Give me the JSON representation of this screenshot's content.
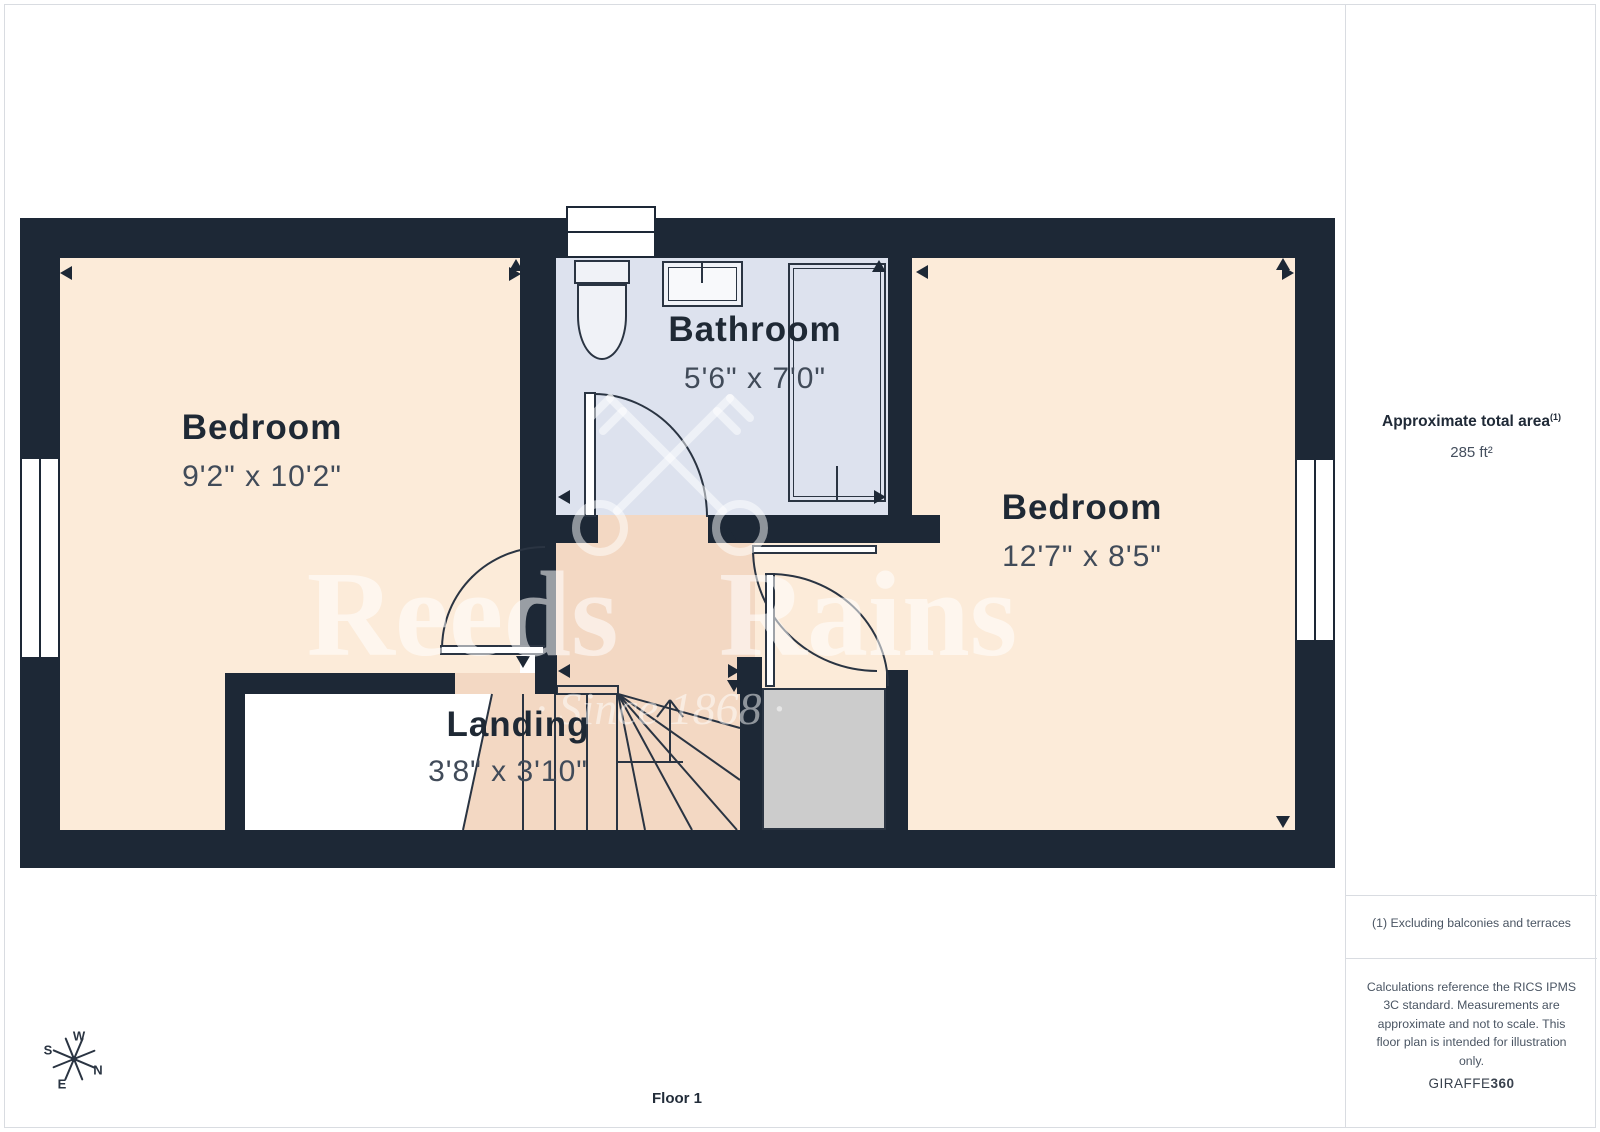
{
  "colors": {
    "wall": "#1d2836",
    "line": "#2a3442",
    "room_fill": "#fcebd9",
    "landing_fill": "#f3d8c3",
    "bathroom_fill": "#dde2ee",
    "closet_fill": "#cccccc",
    "border": "#d9dce1",
    "text_dark": "#1f2935",
    "text_dim": "#414b59"
  },
  "rooms": {
    "bedroom_left": {
      "name": "Bedroom",
      "dimensions": "9'2\" x 10'2\""
    },
    "bathroom": {
      "name": "Bathroom",
      "dimensions": "5'6\" x 7'0\""
    },
    "bedroom_right": {
      "name": "Bedroom",
      "dimensions": "12'7\" x 8'5\""
    },
    "landing": {
      "name": "Landing",
      "dimensions": "3'8\" x 3'10\""
    }
  },
  "fixtures": [
    "toilet",
    "sink",
    "shower",
    "staircase",
    "wardrobe"
  ],
  "watermark": {
    "line1": "Reeds Rains",
    "line2": "· Since 1868 ·",
    "logo": "crossed-keys"
  },
  "compass": {
    "w": "W",
    "s": "S",
    "n": "N",
    "e": "E"
  },
  "sidebar": {
    "area_label": "Approximate total area",
    "area_superscript": "(1)",
    "area_value": "285 ft²",
    "footnote": "(1) Excluding balconies and terraces",
    "disclaimer": "Calculations reference the RICS IPMS 3C standard. Measurements are approximate and not to scale. This floor plan is intended for illustration only.",
    "brand": "GIRAFFE",
    "brand_suffix": "360"
  },
  "footer": {
    "floor_label": "Floor 1"
  }
}
